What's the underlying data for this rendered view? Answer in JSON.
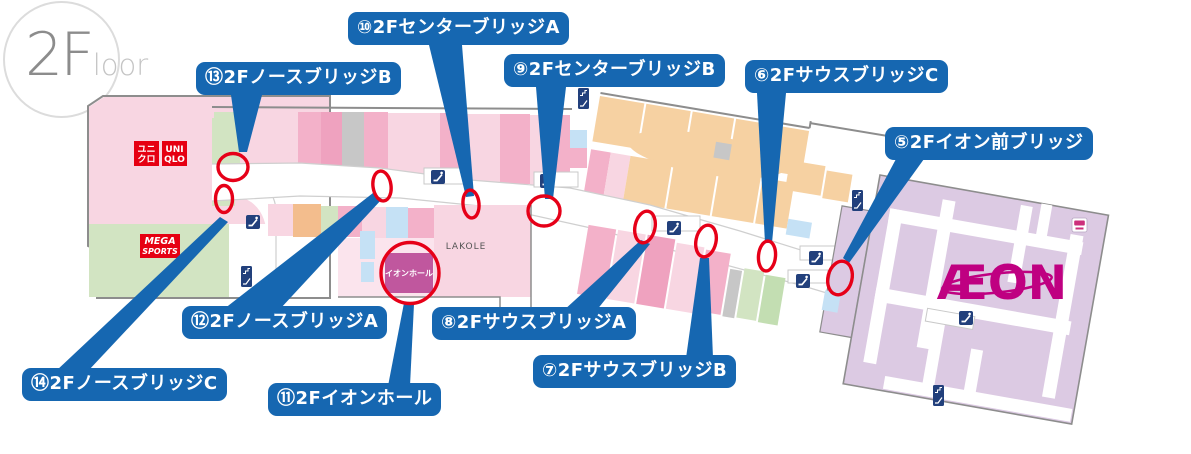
{
  "floor_badge": {
    "number": "2F",
    "suffix": "loor"
  },
  "labels": [
    {
      "id": "5",
      "text": "⑤2Fイオン前ブリッジ"
    },
    {
      "id": "6",
      "text": "⑥2FサウスブリッジC"
    },
    {
      "id": "7",
      "text": "⑦2FサウスブリッジB"
    },
    {
      "id": "8",
      "text": "⑧2FサウスブリッジA"
    },
    {
      "id": "9",
      "text": "⑨2FセンターブリッジB"
    },
    {
      "id": "10",
      "text": "⑩2FセンターブリッジA"
    },
    {
      "id": "11",
      "text": "⑪2Fイオンホール"
    },
    {
      "id": "12",
      "text": "⑫2FノースブリッジA"
    },
    {
      "id": "13",
      "text": "⑬2FノースブリッジB"
    },
    {
      "id": "14",
      "text": "⑭2FノースブリッジC"
    }
  ],
  "stores": {
    "uniqlo": {
      "jp_line1": "ユニ",
      "jp_line2": "クロ",
      "en_line1": "UNI",
      "en_line2": "QLO"
    },
    "mega_sports": {
      "line1": "MEGA",
      "line2": "SPORTS"
    },
    "lakole": {
      "name": "LAKOLE"
    },
    "aeon_hall": {
      "name": "イオンホール"
    },
    "aeon": {
      "logo": "ÆON"
    }
  },
  "icons": {
    "escalator": "escalator-icon",
    "stairs": "stairs-icon",
    "restroom": "restroom-icon"
  },
  "colors": {
    "label_blue": "#1667b1",
    "marker_red": "#e60018",
    "aeon_magenta": "#bf0081",
    "uniqlo_red": "#e60012",
    "aeon_lavender": "#dccae3",
    "tan": "#f6d1a2",
    "pink_light": "#f8d6e2",
    "pink_medium": "#f3b1c9",
    "green_light": "#d2e4c2",
    "blue_light": "#c5e1f5",
    "gray_tile": "#c7c7c7",
    "outline_gray": "#8d8d8d"
  }
}
